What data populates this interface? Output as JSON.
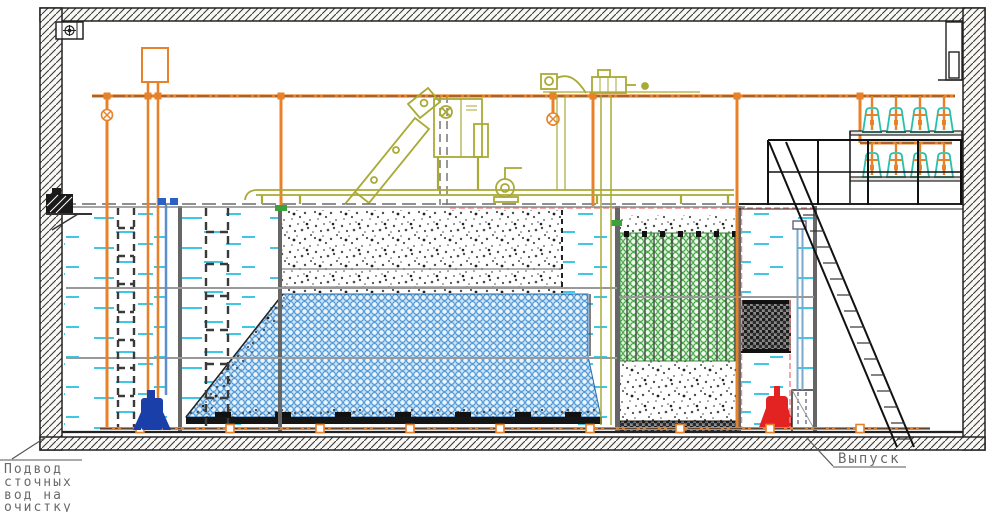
{
  "labels": {
    "inlet_line1": "Подвод",
    "inlet_line2": "сточных",
    "inlet_line3": "вод на",
    "inlet_line4": "очистку",
    "outlet": "Выпуск"
  },
  "colors": {
    "pipe_orange": "#E8822A",
    "equipment_olive": "#A9AA35",
    "water_cyan": "#3FC8E6",
    "media_blue": "#4A94D4",
    "media_green": "#3AA23A",
    "blower_teal": "#2BBFA9",
    "pump_red": "#E32222",
    "pump_blue": "#1A3FA8",
    "level_pink": "#F08A8A",
    "line_dark": "#1E1E1E",
    "label_gray": "#6A6A6A"
  },
  "components": {
    "building": "hatched-section-walls",
    "ventilation": "wall-fan-unit",
    "air_system": "orange-air-main-with-risers-and-bottom-header",
    "blowers": "two-shelves-of-four-teal-blowers",
    "tanks": [
      "inlet-water-tank",
      "settling-tank",
      "aeration-tank-with-blue-carrier-media",
      "green-biofilter-tank",
      "outlet-clear-water-tank"
    ],
    "media": [
      "gray-floating-media-stipple",
      "blue-carrier-media-pile",
      "green-biofilter-media",
      "dark-media-block"
    ],
    "equipment": [
      "inclined-screen-unit",
      "control-cabinet",
      "screw-pump",
      "drive-motor",
      "service-table"
    ],
    "pumps": [
      "blue-submersible-pump",
      "red-submersible-pump"
    ],
    "access": [
      "platform-railing",
      "staircase",
      "tank-ladders"
    ]
  }
}
